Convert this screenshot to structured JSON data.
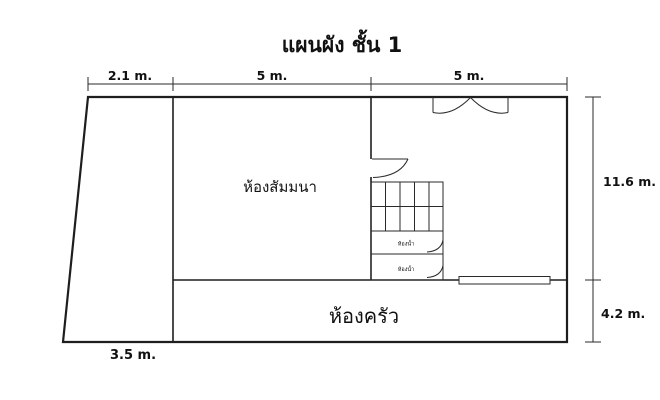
{
  "title": "แผนผัง ชั้น 1",
  "colors": {
    "line": "#1e1e1e",
    "background": "#ffffff",
    "text": "#111111"
  },
  "dimensions": {
    "top_left_width": {
      "label": "2.1 m."
    },
    "top_middle_width": {
      "label": "5 m."
    },
    "top_right_width": {
      "label": "5 m."
    },
    "right_upper_height": {
      "label": "11.6 m."
    },
    "right_lower_height": {
      "label": "4.2 m."
    },
    "bottom_left_width": {
      "label": "3.5 m."
    }
  },
  "rooms": {
    "seminar_room": {
      "label": "ห้องสัมมนา"
    },
    "kitchen": {
      "label": "ห้องครัว"
    },
    "bathroom_upper": {
      "label": "ห้องน้ำ"
    },
    "bathroom_lower": {
      "label": "ห้องน้ำ"
    }
  }
}
